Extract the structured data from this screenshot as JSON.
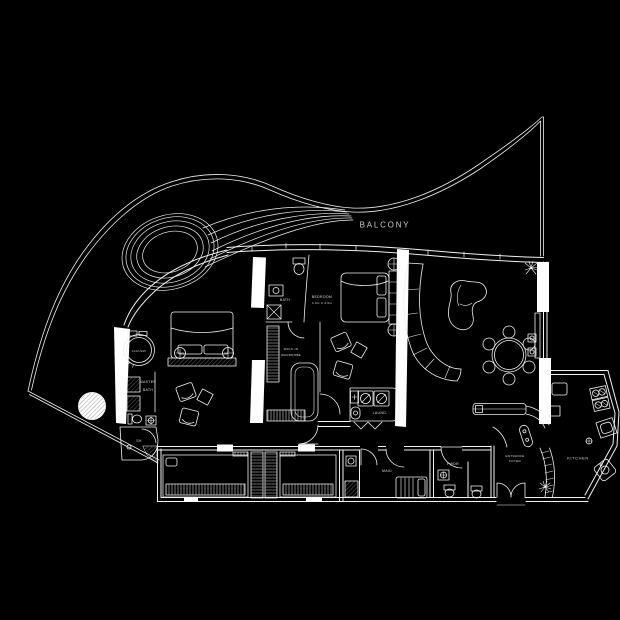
{
  "canvas": {
    "width": 620,
    "height": 620,
    "background": "#000000",
    "line_color": "#f2f2f2"
  },
  "labels": {
    "balcony": "BALCONY",
    "jacuzzi": "JACUZZI",
    "master_bath_line1": "MASTER",
    "master_bath_line2": "BATH",
    "shower": "SH",
    "bath": "BATH",
    "walkin_line1": "WALK-IN",
    "walkin_line2": "WARDROBE",
    "bedroom_line1": "BEDROOM",
    "bedroom_line2": "4.0m X 4.0m",
    "laundry": "LAUND.",
    "maid": "MAID",
    "powder": "PWDR",
    "entrance_line1": "ENTRANCE",
    "entrance_line2": "FOYER",
    "kitchen": "KITCHEN"
  }
}
